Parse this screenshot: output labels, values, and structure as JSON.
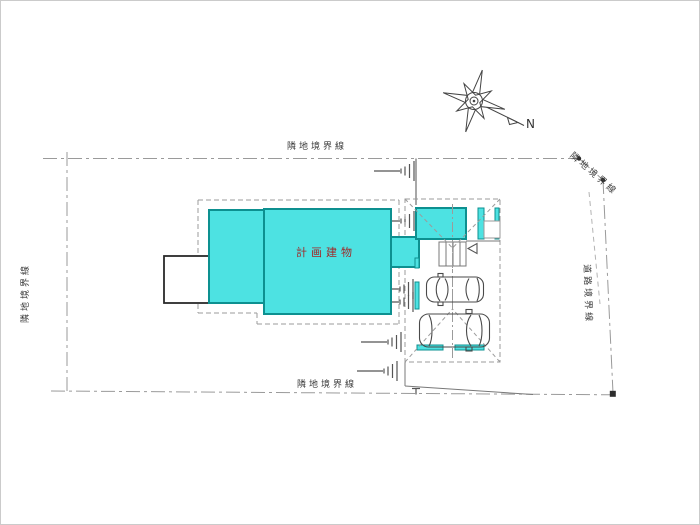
{
  "canvas": {
    "background": "#ffffff",
    "frame_color": "#cbcbcb"
  },
  "boundaries": {
    "top_label": "隣地境界線",
    "left_label": "隣地境界線",
    "bottom_label": "隣地境界線",
    "top_right_label": "隣地境界線",
    "right_label": "道路境界線",
    "line_color": "#9a9a9a"
  },
  "building": {
    "label": "計画建物",
    "fill_color": "#4de2e2",
    "outline_color": "#0d9090",
    "label_color": "#a02828"
  },
  "compass": {
    "north_label": "N"
  }
}
